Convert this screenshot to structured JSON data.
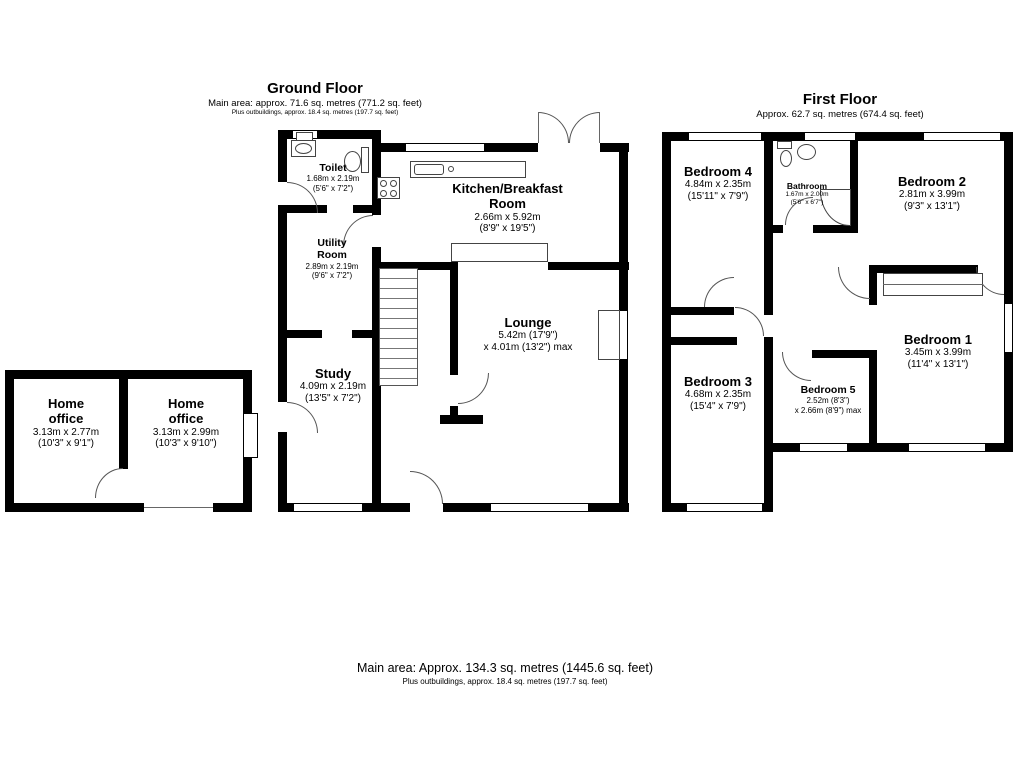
{
  "colors": {
    "wall": "#000000",
    "thin_line": "#555555",
    "text": "#000000",
    "background": "#ffffff"
  },
  "headers": {
    "ground": {
      "title": "Ground Floor",
      "line1": "Main area: approx. 71.6 sq. metres (771.2 sq. feet)",
      "line2": "Plus outbuildings, approx. 18.4 sq. metres (197.7 sq. feet)"
    },
    "first": {
      "title": "First Floor",
      "line1": "Approx. 62.7 sq. metres (674.4 sq. feet)"
    },
    "footer": {
      "line1": "Main area: Approx. 134.3 sq. metres (1445.6 sq. feet)",
      "line2": "Plus outbuildings, approx. 18.4 sq. metres (197.7 sq. feet)"
    }
  },
  "rooms": {
    "toilet": {
      "name": "Toilet",
      "dim1": "1.68m x 2.19m",
      "dim2": "(5'6\" x 7'2\")"
    },
    "kitchen": {
      "name": "Kitchen/Breakfast Room",
      "dim1": "2.66m x 5.92m",
      "dim2": "(8'9\" x 19'5\")"
    },
    "utility": {
      "name": "Utility Room",
      "dim1": "2.89m x 2.19m",
      "dim2": "(9'6\" x 7'2\")"
    },
    "lounge": {
      "name": "Lounge",
      "dim1": "5.42m (17'9\")",
      "dim2": "x 4.01m (13'2\") max"
    },
    "study": {
      "name": "Study",
      "dim1": "4.09m x 2.19m",
      "dim2": "(13'5\" x 7'2\")"
    },
    "home_office_left": {
      "name": "Home office",
      "dim1": "3.13m x 2.77m",
      "dim2": "(10'3\" x 9'1\")"
    },
    "home_office_right": {
      "name": "Home office",
      "dim1": "3.13m x 2.99m",
      "dim2": "(10'3\" x 9'10\")"
    },
    "bedroom4": {
      "name": "Bedroom 4",
      "dim1": "4.84m x 2.35m",
      "dim2": "(15'11\" x 7'9\")"
    },
    "bathroom": {
      "name": "Bathroom",
      "dim1": "1.67m x 2.00m",
      "dim2": "(5'6\" x 6'7\")"
    },
    "bedroom2": {
      "name": "Bedroom 2",
      "dim1": "2.81m x 3.99m",
      "dim2": "(9'3\" x 13'1\")"
    },
    "bedroom1": {
      "name": "Bedroom 1",
      "dim1": "3.45m x 3.99m",
      "dim2": "(11'4\" x 13'1\")"
    },
    "bedroom3": {
      "name": "Bedroom 3",
      "dim1": "4.68m x 2.35m",
      "dim2": "(15'4\" x 7'9\")"
    },
    "bedroom5": {
      "name": "Bedroom 5",
      "dim1": "2.52m (8'3\")",
      "dim2": "x 2.66m (8'9\") max"
    }
  },
  "fixtures": {
    "ground": [
      "toilet-wc",
      "toilet-sink",
      "boiler",
      "kitchen-counter",
      "kitchen-sink",
      "stove-hob",
      "sideboard",
      "staircase",
      "chimney-breast"
    ],
    "first": [
      "bathroom-wc",
      "bathroom-sink",
      "shower-enclosure",
      "wardrobe"
    ]
  }
}
